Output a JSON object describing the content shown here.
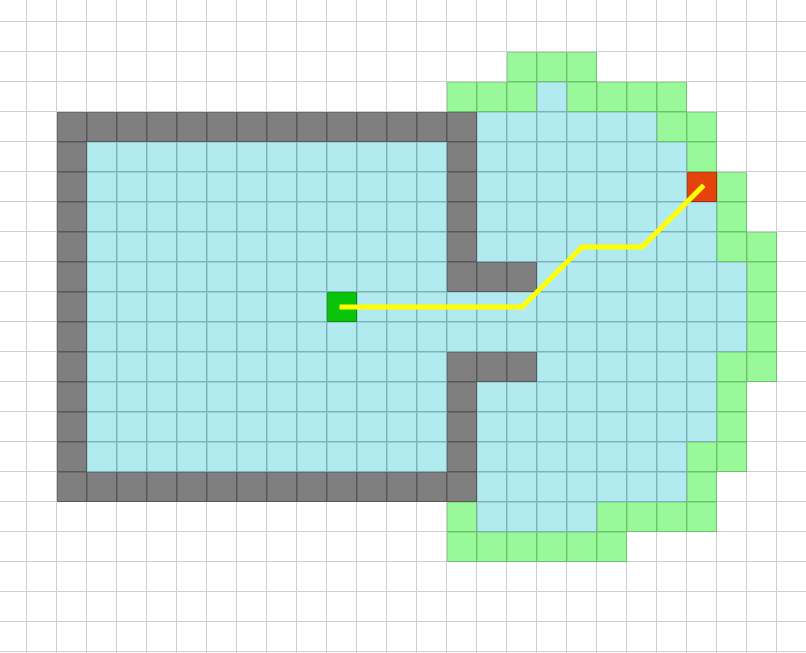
{
  "grid": {
    "cell_size": 30,
    "origin_x": -3,
    "origin_y": -8,
    "cols": 27,
    "rows": 23,
    "legend": {
      ".": "empty",
      "W": "wall",
      "C": "free",
      "F": "frontier",
      "S": "start",
      "R": "goal"
    },
    "cells": [
      "...........................",
      "...........................",
      ".................FFF.......",
      "...............FFFCFFFF....",
      "..WWWWWWWWWWWWWWCCCCCCFF...",
      "..WCCCCCCCCCCCCWCCCCCCCF...",
      "..WCCCCCCCCCCCCWCCCCCCCRF..",
      "..WCCCCCCCCCCCCWCCCCCCCCF..",
      "..WCCCCCCCCCCCCWCCCCCCCCFF.",
      "..WCCCCCCCCCCCCWWWCCCCCCCF.",
      "..WCCCCCCCCSCCCCCCCCCCCCCF.",
      "..WCCCCCCCCCCCCCCCCCCCCCCF.",
      "..WCCCCCCCCCCCCWWWCCCCCCFF.",
      "..WCCCCCCCCCCCCWCCCCCCCCF..",
      "..WCCCCCCCCCCCCWCCCCCCCCF..",
      "..WCCCCCCCCCCCCWCCCCCCCFF..",
      "..WWWWWWWWWWWWWWCCCCCCCF...",
      "...............FCCCCFFFF...",
      "...............FFFFFF......",
      "...........................",
      "...........................",
      "...........................",
      "..........................."
    ]
  },
  "colors": {
    "background": "#ffffff",
    "grid_line": "#cfcfcf",
    "free": "#b2ebef",
    "wall": "#7f7f7f",
    "frontier": "#99f899",
    "start": "#0bc30b",
    "goal": "#e5430e",
    "path": "#ffff00"
  },
  "path": {
    "stroke_width": 5,
    "waypoints_cells": [
      [
        11,
        10
      ],
      [
        17,
        10
      ],
      [
        19,
        8
      ],
      [
        21,
        8
      ],
      [
        23,
        6
      ]
    ]
  }
}
